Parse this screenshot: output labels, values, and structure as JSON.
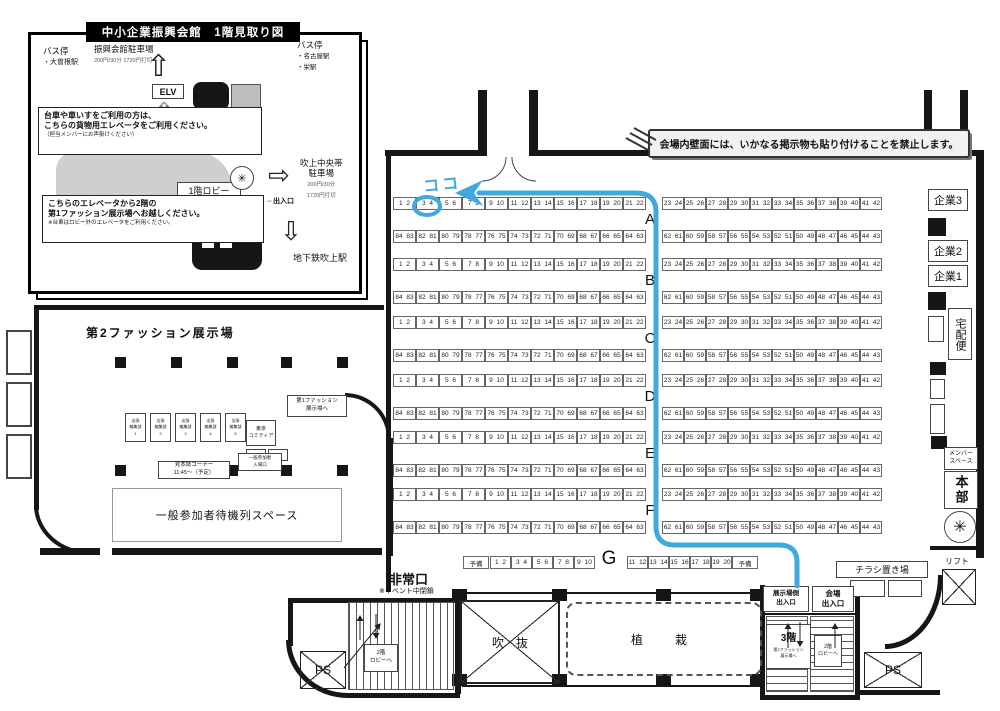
{
  "inset1": {
    "title": "中小企業振興会館　1階見取り図",
    "bus_left": {
      "l1": "バス停",
      "l2": "・大曽根駅"
    },
    "parking_main": {
      "name": "振興会館駐車場",
      "price": "200円/30分 1720円打切"
    },
    "bus_right": {
      "l1": "バス停",
      "l2": "・名古屋駅",
      "l3": "・栄駅"
    },
    "elv": "ELV",
    "cargo_notice": {
      "l1": "台車や車いすをご利用の方は、",
      "l2": "こちらの貨物用エレベータをご利用ください。",
      "l3": "（担当メンバーにお声掛けください）"
    },
    "lobby": "1階ロビー",
    "parking_right": {
      "l1": "吹上中央帯",
      "l2": "駐車場",
      "l3": "200円/30分",
      "l4": "1720円打切"
    },
    "elevator_notice": {
      "l1": "こちらのエレベータから2階の",
      "l2": "第1ファッション展示場へお越しください。",
      "l3": "※台車はロビー外のエレベータをご利用ください。"
    },
    "entrance": "⇔出入口",
    "subway": "地下鉄吹上駅"
  },
  "inset2": {
    "title": "第2ファッション展示場",
    "desk": {
      "l1": "出張",
      "l2": "編集部",
      "numbers": [
        "1",
        "2",
        "3",
        "4",
        "5"
      ]
    },
    "comitia": {
      "l1": "東京",
      "l2": "コミティア"
    },
    "to_hall1": {
      "l1": "第1ファッション",
      "l2": "展示場へ"
    },
    "sample_corner": {
      "l1": "見本誌コーナー",
      "l2": "11:45～（予定）"
    },
    "visitor_entrance": {
      "l1": "一般参加者",
      "l2": "入場口"
    },
    "waiting": "一般参加者待機列スペース"
  },
  "banner": "会場内壁面には、いかなる掲示物も貼り付けることを禁止します。",
  "hall": {
    "letters": [
      "A",
      "B",
      "C",
      "D",
      "E",
      "F"
    ],
    "upper_left": [
      "1 2",
      "3 4",
      "5 6",
      "7 8",
      "9 10",
      "11 12",
      "13 14",
      "15 16",
      "17 18",
      "19 20",
      "21 22"
    ],
    "upper_right": [
      "23 24",
      "25 26",
      "27 28",
      "29 30",
      "31 32",
      "33 34",
      "35 36",
      "37 38",
      "39 40",
      "41 42"
    ],
    "lower_left": [
      "84 83",
      "82 81",
      "80 79",
      "78 77",
      "76 75",
      "74 73",
      "72 71",
      "70 69",
      "68 67",
      "66 65",
      "64 63"
    ],
    "lower_right": [
      "62 61",
      "60 59",
      "58 57",
      "56 55",
      "54 53",
      "52 51",
      "50 49",
      "48 47",
      "46 45",
      "44 43"
    ],
    "g_row": {
      "letter": "G",
      "reserve": "予備",
      "left": [
        "1 2",
        "3 4",
        "5 6",
        "7 8",
        "9 10"
      ],
      "right": [
        "11 12",
        "13 14",
        "15 16",
        "17 18",
        "19 20"
      ]
    }
  },
  "right_col": {
    "company3": "企業3",
    "company2": "企業2",
    "company1": "企業1",
    "courier": "宅配便",
    "member_space": {
      "l1": "メンバー",
      "l2": "スペース"
    },
    "hq": "本部",
    "lift": "リフト"
  },
  "bottom": {
    "emergency_exit": "非常口",
    "emergency_note": "※イベント中閉鎖",
    "atrium": "吹　抜",
    "planting": "植　栽",
    "flyer_area": "チラシ置き場",
    "hall_side_exit": {
      "l1": "展示場側",
      "l2": "出入口"
    },
    "venue_exit": {
      "l1": "会場",
      "l2": "出入口"
    },
    "floor3": {
      "main": "3階",
      "s1": "第2ファッション",
      "s2": "展示場へ"
    },
    "lobby2_left": {
      "l1": "2階",
      "l2": "ロビーへ"
    },
    "lobby2_right": {
      "l1": "2階",
      "l2": "ロビーへ"
    },
    "ps_left": "PS",
    "ps_right": "PS"
  },
  "route": {
    "marker": "ココ",
    "color": "#3fa9de"
  }
}
